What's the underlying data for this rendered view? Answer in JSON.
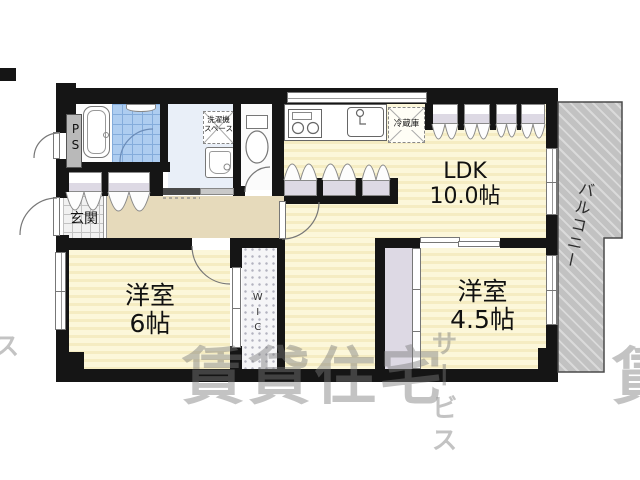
{
  "rooms": {
    "ldk": {
      "name": "LDK",
      "size": "10.0帖"
    },
    "bedroom6": {
      "name": "洋室",
      "size": "6帖"
    },
    "bedroom45": {
      "name": "洋室",
      "size": "4.5帖"
    }
  },
  "areas": {
    "entrance": "玄関",
    "balcony": "バルコニー",
    "wic": "WIC",
    "ps": "PS"
  },
  "fixtures": {
    "fridge": "冷蔵庫",
    "washer_line1": "洗濯機",
    "washer_line2": "スペース"
  },
  "watermark": {
    "main": "賃貸住宅",
    "sub": "サービス",
    "edge_left": "ス",
    "edge_right": "賃"
  },
  "colors": {
    "wall": "#151515",
    "floor": "#fbf4d4",
    "hallway": "#e6dabb",
    "balcony": "#c2c2c2",
    "shower_tile": "#aecdf0",
    "closet": "#ddd9e4",
    "washroom_floor": "#e9eff8",
    "watermark": "#8a8a8a"
  }
}
